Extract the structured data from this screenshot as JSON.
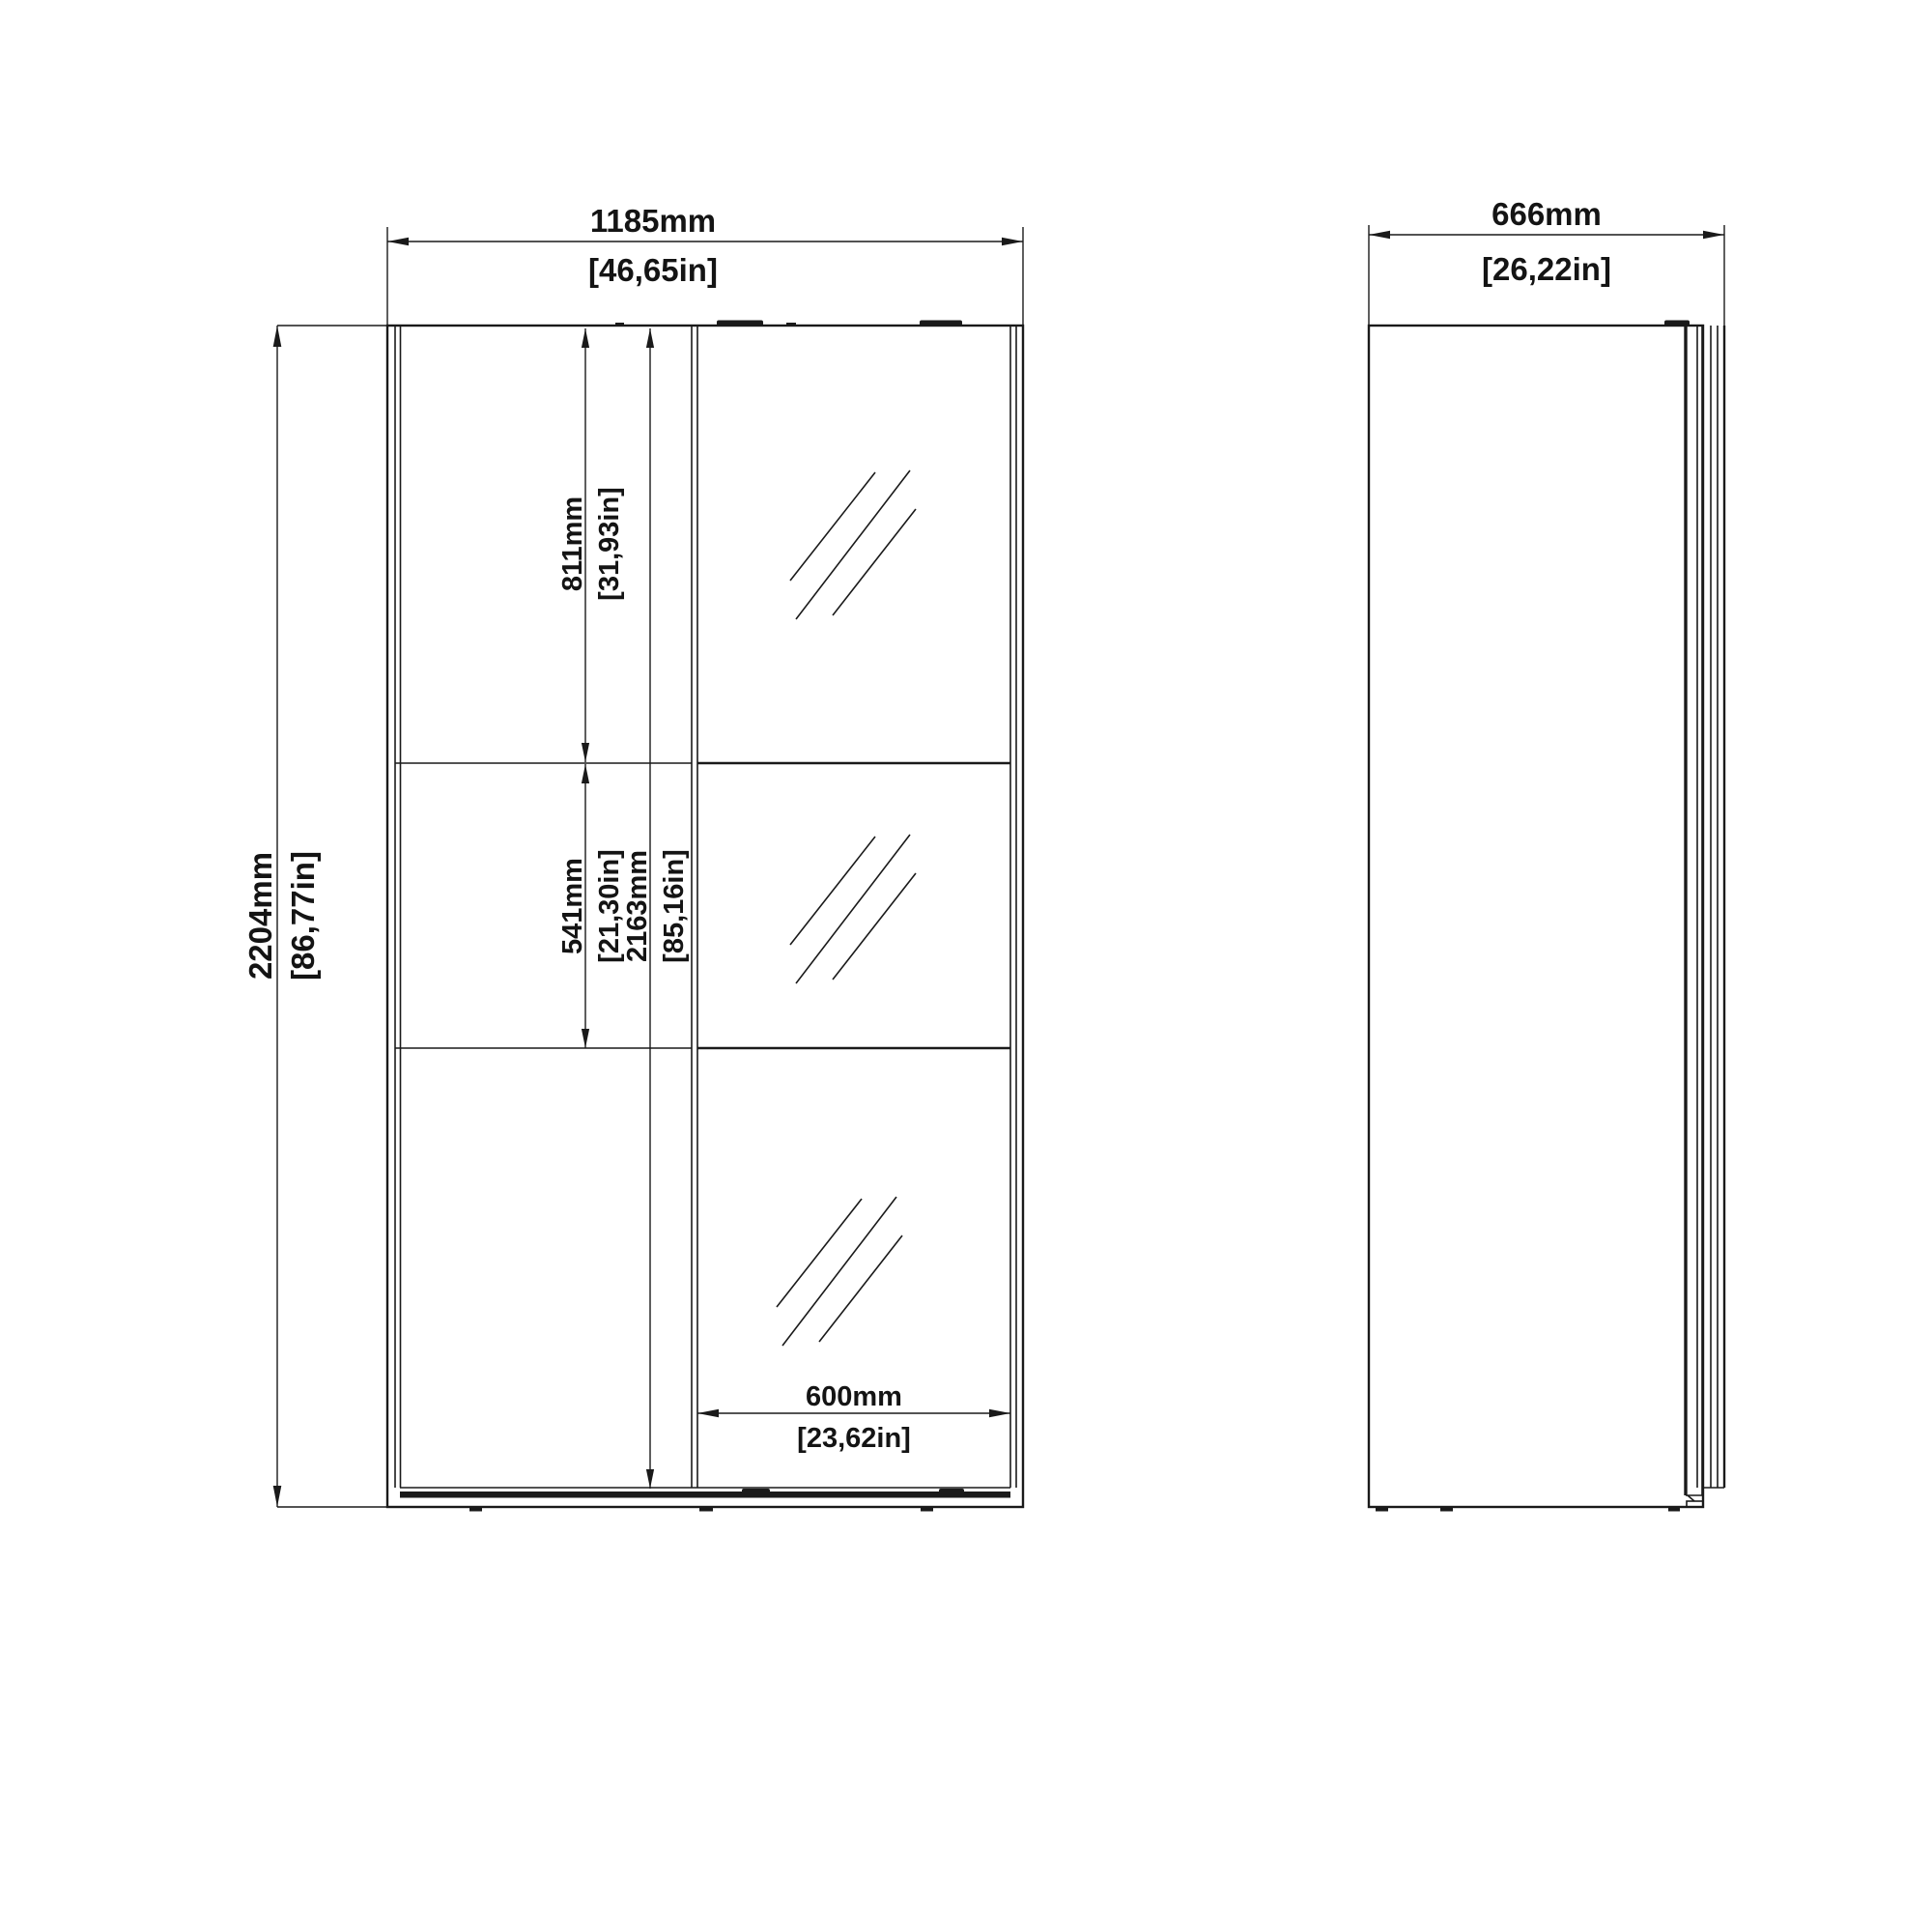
{
  "drawing": {
    "background_color": "#ffffff",
    "line_color": "#1a1a1a",
    "front_view": {
      "width_mm": "1185mm",
      "width_in": "[46,65in]",
      "height_mm": "2204mm",
      "height_in": "[86,77in]",
      "top_section_mm": "811mm",
      "top_section_in": "[31,93in]",
      "middle_section_mm": "541mm",
      "middle_section_in": "[21,30in]",
      "interior_height_mm": "2163mm",
      "interior_height_in": "[85,16in]",
      "door_width_mm": "600mm",
      "door_width_in": "[23,62in]"
    },
    "side_view": {
      "depth_mm": "666mm",
      "depth_in": "[26,22in]"
    }
  }
}
